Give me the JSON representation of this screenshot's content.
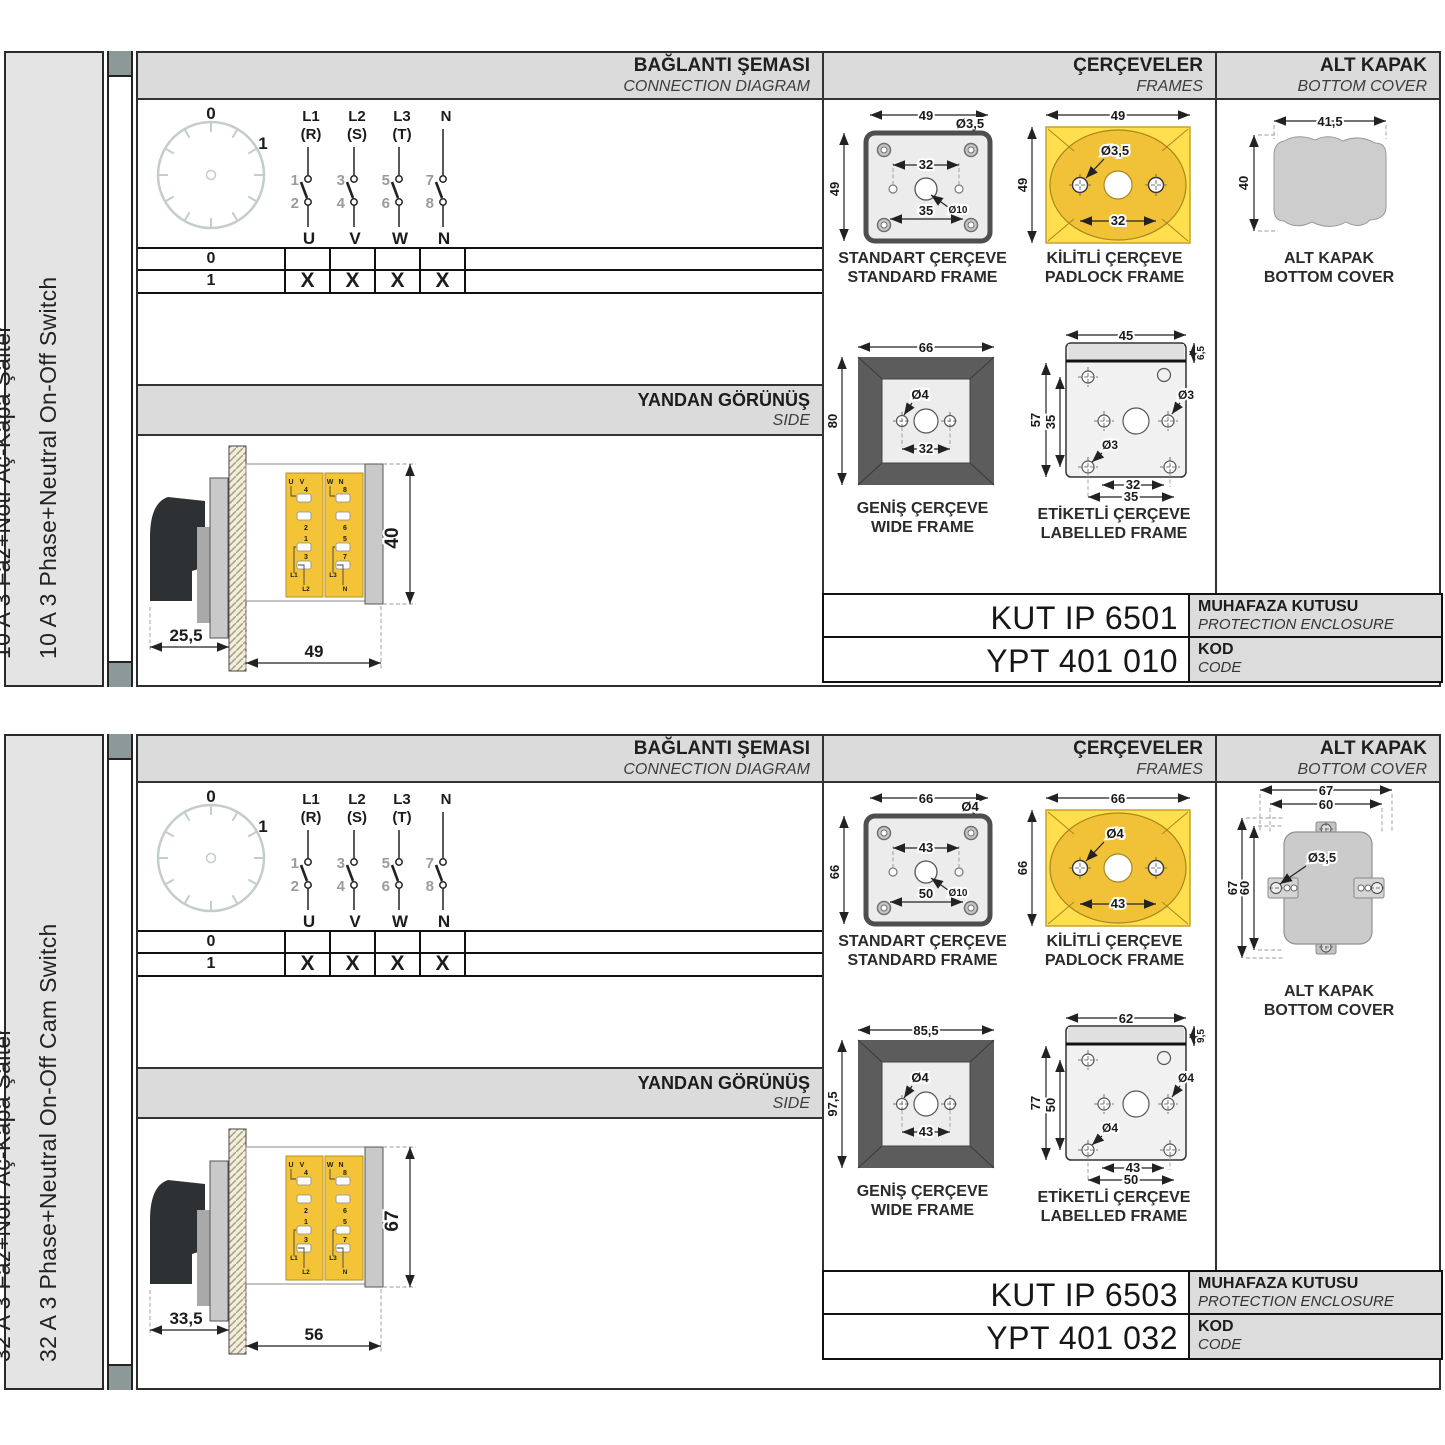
{
  "colors": {
    "accent_yellow": "#FFDF4E",
    "gold": "#F1C237",
    "band_gray": "#DBDBDB",
    "panel_gray": "#E4E4E4",
    "spine_gray": "#8D9899",
    "frame_dark": "#5C5C5C",
    "label_cell_gray": "#DCDCDC"
  },
  "sections": [
    {
      "product": {
        "tr": "10 A 3 Faz+Nötr Aç-Kapa Şalter",
        "en": "10 A 3 Phase+Neutral On-Off Switch"
      },
      "headers": {
        "connection_tr": "BAĞLANTI ŞEMASI",
        "connection_en": "CONNECTION DIAGRAM",
        "frames_tr": "ÇERÇEVELER",
        "frames_en": "FRAMES",
        "cover_tr": "ALT KAPAK",
        "cover_en": "BOTTOM COVER",
        "side_tr": "YANDAN GÖRÜNÜŞ",
        "side_en": "SIDE"
      },
      "diagram": {
        "pos0": "0",
        "pos1": "1",
        "cols": [
          {
            "top": "L1",
            "sub": "(R)",
            "nt": "1",
            "nb": "2",
            "out": "U"
          },
          {
            "top": "L2",
            "sub": "(S)",
            "nt": "3",
            "nb": "4",
            "out": "V"
          },
          {
            "top": "L3",
            "sub": "(T)",
            "nt": "5",
            "nb": "6",
            "out": "W"
          },
          {
            "top": "N",
            "sub": "",
            "nt": "7",
            "nb": "8",
            "out": "N"
          }
        ]
      },
      "table": {
        "r0": "0",
        "r1": "1",
        "marks": [
          "X",
          "X",
          "X",
          "X"
        ]
      },
      "side": {
        "dim_handle": "25,5",
        "dim_width": "49",
        "dim_height": "40",
        "terms": {
          "u": "U",
          "v": "V",
          "w": "W",
          "n": "N",
          "t4": "4",
          "t2": "2",
          "t8": "8",
          "t6": "6",
          "t1": "1",
          "t3": "3",
          "t5": "5",
          "t7": "7",
          "l1": "L1",
          "l2": "L2",
          "l3": "L3",
          "nb": "N"
        }
      },
      "frames": {
        "standard": {
          "cap_tr": "STANDART ÇERÇEVE",
          "cap_en": "STANDARD FRAME",
          "w": "49",
          "h": "49",
          "hole": "Ø3,5",
          "span": "32",
          "span2": "35",
          "center": "Ø10"
        },
        "padlock": {
          "cap_tr": "KİLİTLİ ÇERÇEVE",
          "cap_en": "PADLOCK FRAME",
          "w": "49",
          "h": "49",
          "hole": "Ø3,5",
          "span": "32"
        },
        "wide": {
          "cap_tr": "GENİŞ ÇERÇEVE",
          "cap_en": "WIDE FRAME",
          "w": "66",
          "h": "80",
          "hole": "Ø4",
          "span": "32"
        },
        "labelled": {
          "cap_tr": "ETİKETLİ ÇERÇEVE",
          "cap_en": "LABELLED FRAME",
          "w": "45",
          "strip": "6,5",
          "h": "57",
          "ih": "35",
          "hole1": "Ø3",
          "hole2": "Ø3",
          "span1": "32",
          "span2": "35"
        }
      },
      "cover": {
        "cap_tr": "ALT KAPAK",
        "cap_en": "BOTTOM COVER",
        "w": "41,5",
        "h": "40"
      },
      "codes": {
        "enclosure": "KUT IP 6501",
        "enclosure_tr": "MUHAFAZA KUTUSU",
        "enclosure_en": "PROTECTION ENCLOSURE",
        "code": "YPT 401 010",
        "code_tr": "KOD",
        "code_en": "CODE"
      }
    },
    {
      "product": {
        "tr": "32 A 3 Faz+Nötr Aç-Kapa Şalter",
        "en": "32 A 3 Phase+Neutral On-Off Cam Switch"
      },
      "headers": {
        "connection_tr": "BAĞLANTI ŞEMASI",
        "connection_en": "CONNECTION DIAGRAM",
        "frames_tr": "ÇERÇEVELER",
        "frames_en": "FRAMES",
        "cover_tr": "ALT KAPAK",
        "cover_en": "BOTTOM COVER",
        "side_tr": "YANDAN GÖRÜNÜŞ",
        "side_en": "SIDE"
      },
      "diagram": {
        "pos0": "0",
        "pos1": "1",
        "cols": [
          {
            "top": "L1",
            "sub": "(R)",
            "nt": "1",
            "nb": "2",
            "out": "U"
          },
          {
            "top": "L2",
            "sub": "(S)",
            "nt": "3",
            "nb": "4",
            "out": "V"
          },
          {
            "top": "L3",
            "sub": "(T)",
            "nt": "5",
            "nb": "6",
            "out": "W"
          },
          {
            "top": "N",
            "sub": "",
            "nt": "7",
            "nb": "8",
            "out": "N"
          }
        ]
      },
      "table": {
        "r0": "0",
        "r1": "1",
        "marks": [
          "X",
          "X",
          "X",
          "X"
        ]
      },
      "side": {
        "dim_handle": "33,5",
        "dim_width": "56",
        "dim_height": "67",
        "terms": {
          "u": "U",
          "v": "V",
          "w": "W",
          "n": "N",
          "t4": "4",
          "t2": "2",
          "t8": "8",
          "t6": "6",
          "t1": "1",
          "t3": "3",
          "t5": "5",
          "t7": "7",
          "l1": "L1",
          "l2": "L2",
          "l3": "L3",
          "nb": "N"
        }
      },
      "frames": {
        "standard": {
          "cap_tr": "STANDART ÇERÇEVE",
          "cap_en": "STANDARD FRAME",
          "w": "66",
          "h": "66",
          "hole": "Ø4",
          "span": "43",
          "span2": "50",
          "center": "Ø10"
        },
        "padlock": {
          "cap_tr": "KİLİTLİ ÇERÇEVE",
          "cap_en": "PADLOCK FRAME",
          "w": "66",
          "h": "66",
          "hole": "Ø4",
          "span": "43"
        },
        "wide": {
          "cap_tr": "GENİŞ ÇERÇEVE",
          "cap_en": "WIDE FRAME",
          "w": "85,5",
          "h": "97,5",
          "hole": "Ø4",
          "span": "43"
        },
        "labelled": {
          "cap_tr": "ETİKETLİ ÇERÇEVE",
          "cap_en": "LABELLED FRAME",
          "w": "62",
          "strip": "9,5",
          "h": "77",
          "ih": "50",
          "hole1": "Ø4",
          "hole2": "Ø4",
          "span1": "43",
          "span2": "50"
        }
      },
      "cover": {
        "cap_tr": "ALT KAPAK",
        "cap_en": "BOTTOM COVER",
        "w_outer": "67",
        "w_inner": "60",
        "h_outer": "67",
        "h_inner": "60",
        "hole": "Ø3,5"
      },
      "codes": {
        "enclosure": "KUT IP 6503",
        "enclosure_tr": "MUHAFAZA KUTUSU",
        "enclosure_en": "PROTECTION ENCLOSURE",
        "code": "YPT 401 032",
        "code_tr": "KOD",
        "code_en": "CODE"
      }
    }
  ]
}
